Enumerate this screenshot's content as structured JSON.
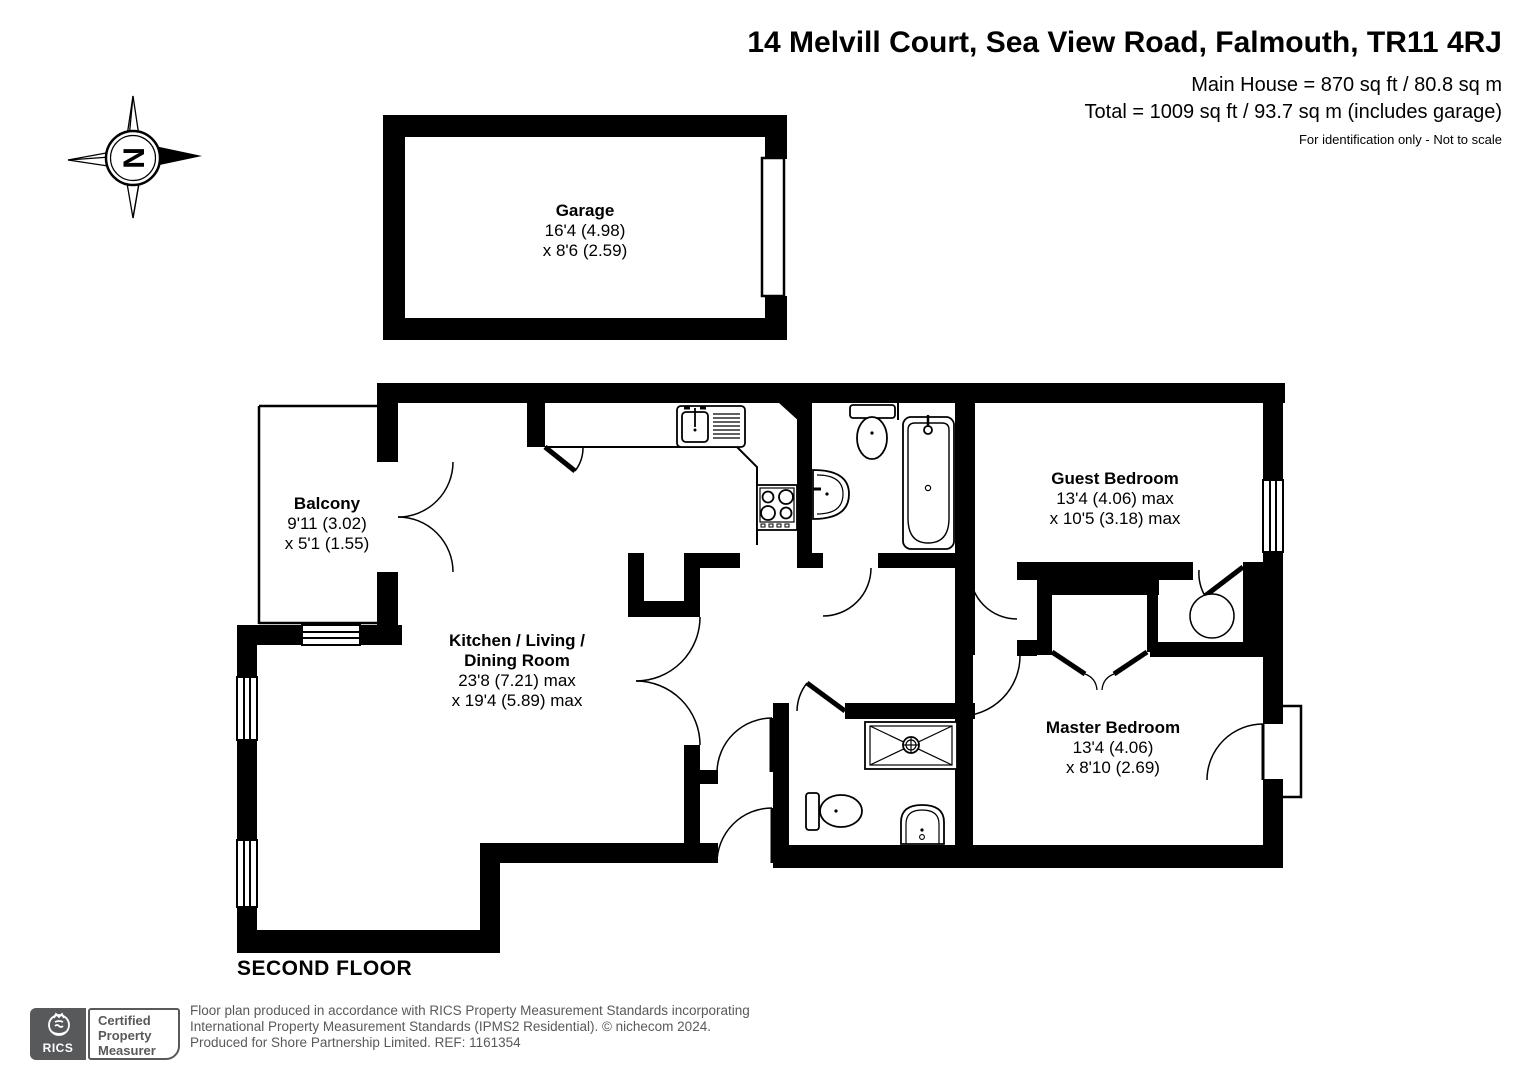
{
  "header": {
    "title": "14 Melvill Court, Sea View Road, Falmouth, TR11 4RJ",
    "area_main": "Main House = 870 sq ft / 80.8 sq m",
    "area_total": "Total = 1009 sq ft / 93.7 sq m (includes garage)",
    "disclaimer": "For identification only - Not to scale"
  },
  "compass": {
    "north_label": "N"
  },
  "rooms": {
    "garage": {
      "name": "Garage",
      "dim1": "16'4 (4.98)",
      "dim2": "x 8'6 (2.59)"
    },
    "balcony": {
      "name": "Balcony",
      "dim1": "9'11 (3.02)",
      "dim2": "x 5'1 (1.55)"
    },
    "kitchen_living_dining": {
      "name_line1": "Kitchen / Living /",
      "name_line2": "Dining Room",
      "dim1": "23'8 (7.21) max",
      "dim2": "x 19'4 (5.89) max"
    },
    "guest_bedroom": {
      "name": "Guest Bedroom",
      "dim1": "13'4 (4.06) max",
      "dim2": "x 10'5 (3.18) max"
    },
    "master_bedroom": {
      "name": "Master Bedroom",
      "dim1": "13'4 (4.06)",
      "dim2": "x 8'10 (2.69)"
    }
  },
  "floor_label": "SECOND FLOOR",
  "footer": {
    "rics_logo_text": "RICS",
    "badge_line1": "Certified",
    "badge_line2": "Property",
    "badge_line3": "Measurer",
    "line1": "Floor plan produced in accordance with RICS Property Measurement Standards incorporating",
    "line2": "International Property Measurement Standards (IPMS2 Residential).   © nichecom 2024.",
    "line3": "Produced for Shore Partnership Limited.   REF:  1161354"
  },
  "colors": {
    "wall": "#000000",
    "background": "#ffffff",
    "footer_gray": "#58595b"
  }
}
